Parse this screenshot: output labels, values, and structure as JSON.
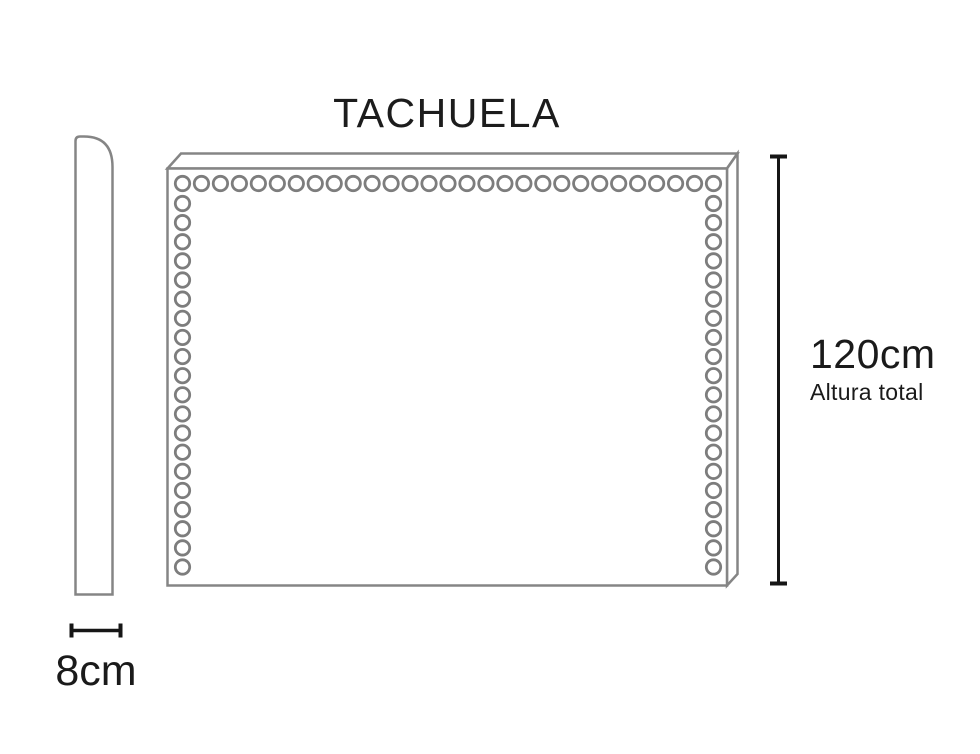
{
  "diagram": {
    "title": "TACHUELA",
    "height_dimension": {
      "value": "120cm",
      "label": "Altura total"
    },
    "depth_dimension": {
      "value": "8cm"
    },
    "colors": {
      "background": "#ffffff",
      "drawing_line": "#858585",
      "tack_line": "#7d7d7d",
      "dimension_line": "#161616",
      "text": "#1a1a1a"
    },
    "tacks": {
      "radius": 7.2,
      "stroke_width": 2.8,
      "color": "#7d7d7d",
      "lines": [
        {
          "name": "top-row",
          "count": 29,
          "x1": 182.5,
          "y1": 183.5,
          "x2": 713.5,
          "y2": 183.5
        },
        {
          "name": "left-column",
          "count": 20,
          "x1": 182.5,
          "y1": 203.5,
          "x2": 182.5,
          "y2": 567
        },
        {
          "name": "right-column",
          "count": 20,
          "x1": 713.5,
          "y1": 203.5,
          "x2": 713.5,
          "y2": 567
        }
      ]
    }
  }
}
